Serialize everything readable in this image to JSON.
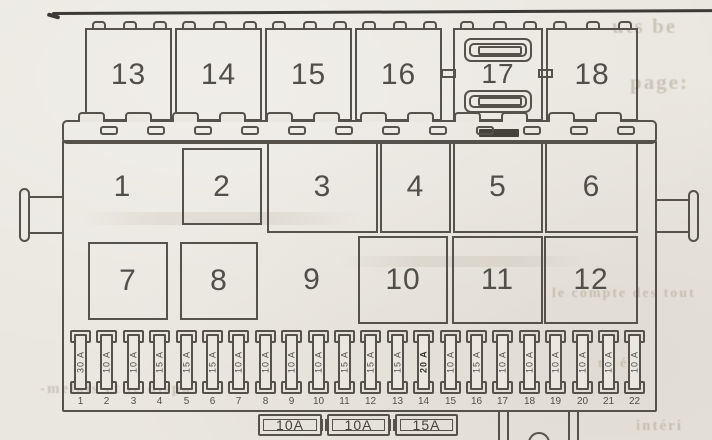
{
  "colors": {
    "paper": "#eae7e0",
    "ink": "#55524b",
    "text": "#514f49"
  },
  "panel": {
    "top_row": {
      "slots": [
        {
          "label": "13"
        },
        {
          "label": "14"
        },
        {
          "label": "15"
        },
        {
          "label": "16"
        },
        {
          "label": "17"
        },
        {
          "label": "18"
        }
      ]
    },
    "grid": {
      "row1": [
        {
          "label": "1"
        },
        {
          "label": "2"
        },
        {
          "label": "3"
        },
        {
          "label": "4"
        },
        {
          "label": "5"
        },
        {
          "label": "6"
        }
      ],
      "row2": [
        {
          "label": "7"
        },
        {
          "label": "8"
        },
        {
          "label": "9"
        },
        {
          "label": "10"
        },
        {
          "label": "11"
        },
        {
          "label": "12"
        }
      ]
    },
    "fuses": {
      "values": [
        "30 A",
        "10 A",
        "10 A",
        "15 A",
        "15 A",
        "15 A",
        "10 A",
        "10 A",
        "10 A",
        "10 A",
        "15 A",
        "15 A",
        "15 A",
        "20 A",
        "10 A",
        "15 A",
        "10 A",
        "10 A",
        "10 A",
        "10 A",
        "10 A",
        "10 A"
      ],
      "numbers": [
        "1",
        "2",
        "3",
        "4",
        "5",
        "6",
        "7",
        "8",
        "9",
        "10",
        "11",
        "12",
        "13",
        "14",
        "15",
        "16",
        "17",
        "18",
        "19",
        "20",
        "21",
        "22"
      ]
    },
    "spare_fuses": [
      {
        "label": "10A"
      },
      {
        "label": "10A"
      },
      {
        "label": "15A"
      }
    ]
  },
  "artifacts": {
    "fragments": [
      {
        "text": "uts be"
      },
      {
        "text": "page:"
      },
      {
        "text": "le compte des tout"
      },
      {
        "text": "nt été"
      },
      {
        "text": "-melais et le dispo"
      },
      {
        "text": "intéri"
      }
    ]
  }
}
